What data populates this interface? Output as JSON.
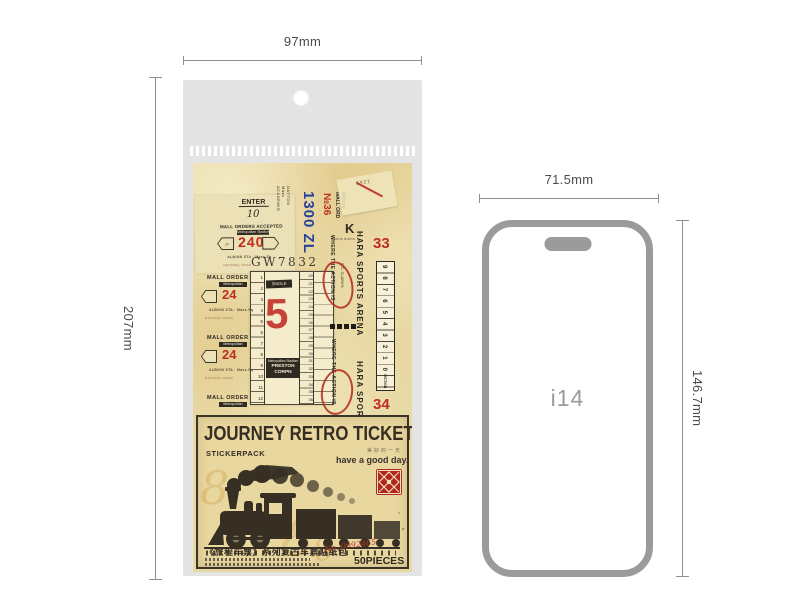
{
  "dimensions": {
    "pack_width": "97mm",
    "pack_height": "207mm",
    "phone_width": "71.5mm",
    "phone_height": "146.7mm"
  },
  "phone": {
    "label": "i14"
  },
  "collage": {
    "enter": "ENTER",
    "enter_no": "10",
    "orders_header": "MALL ORDERS ACCEPTED",
    "orders_bar": "Metropolitan Stadium",
    "fare_240": "240",
    "arrow_no": "10",
    "cap1": "ALBION STA · Mass Sq",
    "cap2": "NATIONAL ROAD",
    "academig": "ACADEMIG\nMass\nDAYTON",
    "price_blue": "1300 ZL",
    "no36": "№36",
    "mall_ord": "MALL ORD\nMetrop",
    "k": "K",
    "stamp_1263": "1263",
    "arena_small": "Sports Arena",
    "gw": "GW7832",
    "single": "SINGLE",
    "five": "5",
    "left_nums": "1\n2\n3\n4\n5\n6\n7\n8\n9\n10\n11\n12",
    "right_nums": "20\n21\n22\n23\n24\n25\n26\n27\n28\n29\n30\n31\n32\n33\n34\n35\n36",
    "box_line1": "Metropolitan Stadium",
    "box_line2": "PRESTON CORPN",
    "mall_order": "MALL ORDER",
    "metropolitan": "Metropolitan",
    "fare_24": "24",
    "hara_arena": "HARA SPORTS ARENA",
    "hara_sports": "HARA SPORTS",
    "n33": "33",
    "n34": "34",
    "ruler_digits": "9 8 7 6 5 4 3 2 1 0",
    "ruler_label": "SECTION",
    "action": "WHERE THE ACTION IS",
    "clark": "D.C. CLARK'S"
  },
  "label": {
    "title": "JOURNEY RETRO TICKET",
    "subtitle": "STICKERPACK",
    "tagline_cn": "美好的一天",
    "tagline": "have a good day.",
    "series_cn": "《旅程车票》系列复古车票贴纸包",
    "serial": "No. 0992465",
    "count": "50PIECES",
    "watermark": "8"
  },
  "colors": {
    "paper": "#e8d9a4",
    "ink": "#2e2a22",
    "accent_red": "#bf2c22",
    "accent_blue": "#27419b",
    "bag_gray": "#e4e4e4",
    "dim_gray": "#8f8f8f",
    "stamp_red": "#b1271c"
  }
}
